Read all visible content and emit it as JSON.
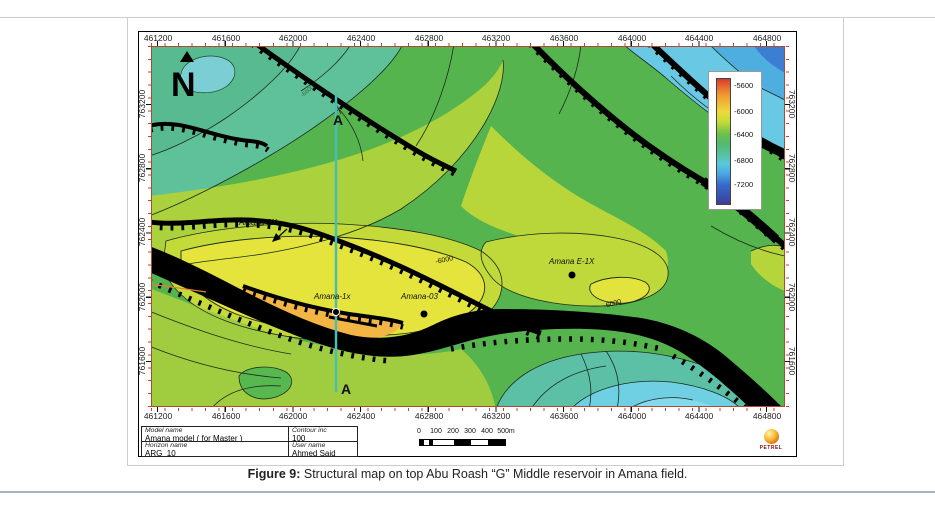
{
  "figure": {
    "caption_prefix": "Figure 9:",
    "caption_text": " Structural map on top Abu Roash “G” Middle reservoir in Amana field."
  },
  "axes": {
    "x": [
      "461200",
      "461600",
      "462000",
      "462400",
      "462800",
      "463200",
      "463600",
      "464000",
      "464400",
      "464800"
    ],
    "y": [
      "763200",
      "762800",
      "762400",
      "762000",
      "761600"
    ]
  },
  "colorbar": {
    "labels": [
      "-5600",
      "-6000",
      "-6400",
      "-6800",
      "-7200"
    ],
    "top_color": "#d63a2e",
    "bottom_color": "#3d3f98"
  },
  "map": {
    "north": "N",
    "section_a_top": "A",
    "section_a_bottom": "A",
    "wells": {
      "amana2x": "Amana-2X",
      "amana1x": "Amana-1x",
      "amana03": "Amana-03",
      "amanaE1x": "Amana E-1X"
    },
    "contour_labels": {
      "west": "-6000",
      "east": "-6000",
      "small": "-6600"
    }
  },
  "info_table": {
    "model_label": "Model name",
    "model_value": "Amana model ( for Master )",
    "contour_label": "Contour inc",
    "contour_value": "100",
    "horizon_label": "Horizon name",
    "horizon_value": "ARG_10",
    "user_label": "User name",
    "user_value": "Ahmed Said"
  },
  "scalebar": {
    "ticks": [
      "0",
      "100",
      "200",
      "300",
      "400",
      "500m"
    ]
  },
  "logo": {
    "text": "PETREL"
  }
}
